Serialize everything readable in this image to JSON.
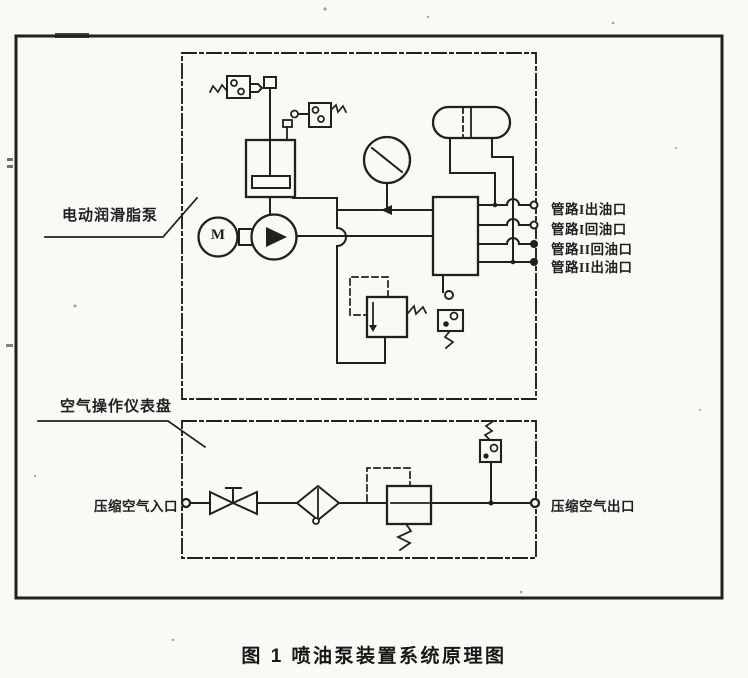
{
  "caption": "图 1  喷油泵装置系统原理图",
  "units": {
    "grease_pump": {
      "label": "电动润滑脂泵"
    },
    "air_panel": {
      "label": "空气操作仪表盘"
    }
  },
  "ports": {
    "oil": [
      "管路I出油口",
      "管路I回油口",
      "管路II回油口",
      "管路II出油口"
    ],
    "air_inlet": "压缩空气入口",
    "air_outlet": "压缩空气出口"
  },
  "symbols": {
    "motor_letter": "M"
  },
  "colors": {
    "ink": "#1f1f1f",
    "paper": "#f9f9f6"
  }
}
